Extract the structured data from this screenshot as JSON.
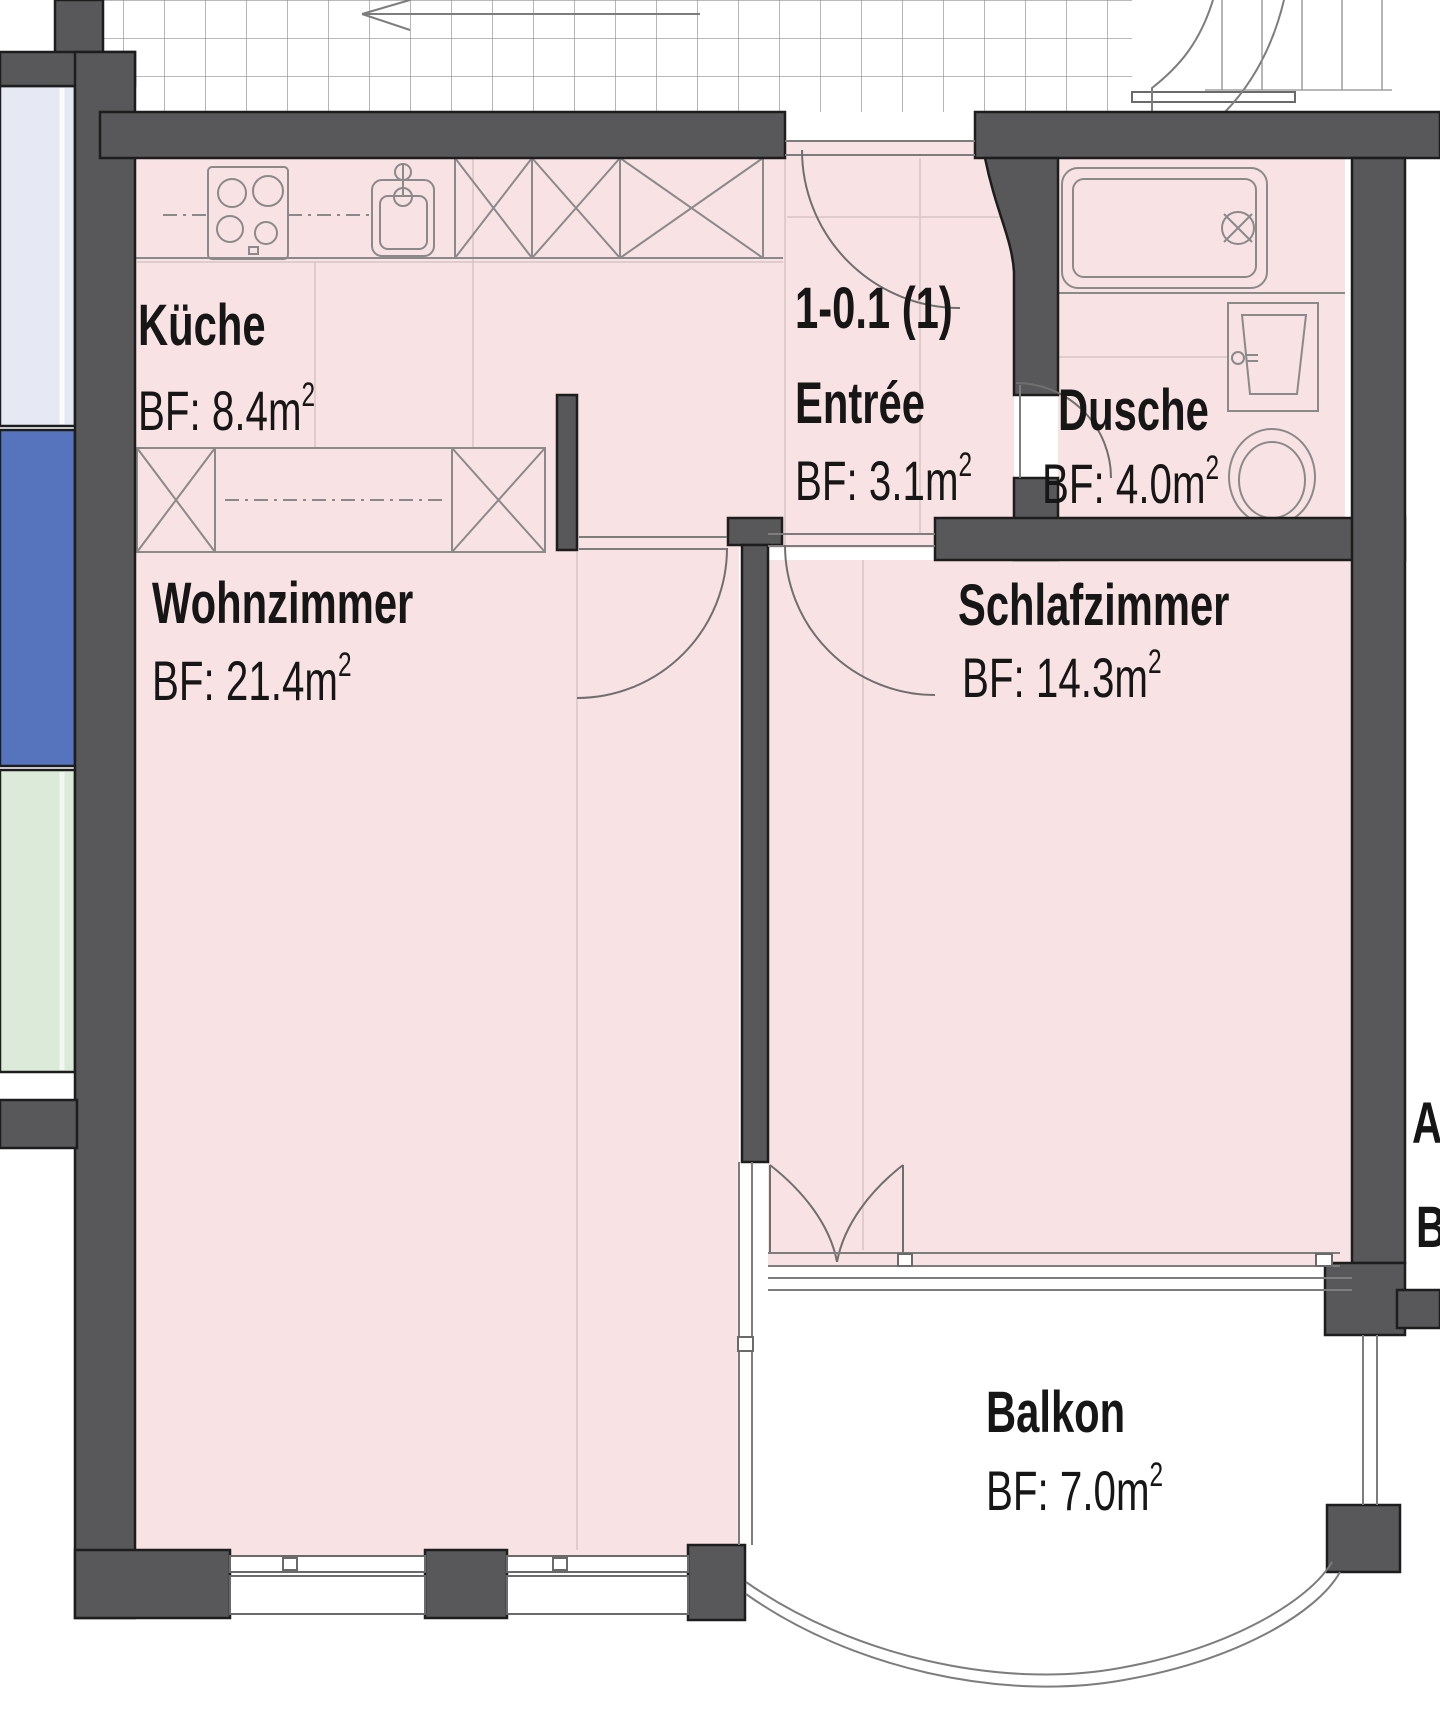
{
  "plan": {
    "apartment_id": "1-0.1 (1)",
    "rooms": [
      {
        "key": "kueche",
        "name": "Küche",
        "area": "BF: 8.4m",
        "sup": "2"
      },
      {
        "key": "entree",
        "name": "Entrée",
        "area": "BF: 3.1m",
        "sup": "2"
      },
      {
        "key": "dusche",
        "name": "Dusche",
        "area": "BF: 4.0m",
        "sup": "2"
      },
      {
        "key": "wohnzimmer",
        "name": "Wohnzimmer",
        "area": "BF: 21.4m",
        "sup": "2"
      },
      {
        "key": "schlafzimmer",
        "name": "Schlafzimmer",
        "area": "BF: 14.3m",
        "sup": "2"
      },
      {
        "key": "balkon",
        "name": "Balkon",
        "area": "BF: 7.0m",
        "sup": "2"
      }
    ],
    "partial_labels": {
      "line1": "A",
      "line2": "B"
    },
    "colors": {
      "wall": "#58585a",
      "wall_outline": "#1d1d1d",
      "room_fill": "#f9e2e3",
      "adjacent_lavender": "#e6e9f4",
      "adjacent_blue": "#5574bd",
      "adjacent_green": "#dcead9",
      "fixture_line": "#8a8a8a"
    }
  }
}
